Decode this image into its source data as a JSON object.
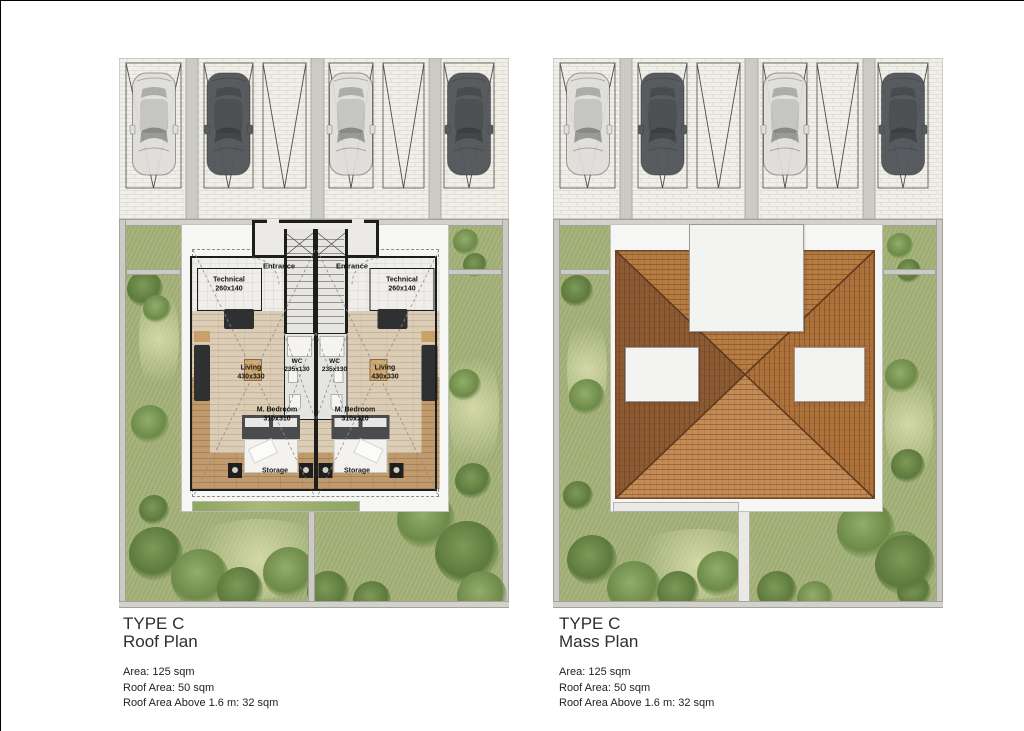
{
  "panels": {
    "roof": {
      "title_line1": "TYPE C",
      "title_line2": "Roof Plan",
      "stat_area": "Area: 125 sqm",
      "stat_roof": "Roof Area: 50 sqm",
      "stat_roof_above": "Roof Area Above 1.6 m: 32 sqm"
    },
    "mass": {
      "title_line1": "TYPE C",
      "title_line2": "Mass Plan",
      "stat_area": "Area: 125 sqm",
      "stat_roof": "Roof Area: 50 sqm",
      "stat_roof_above": "Roof Area Above 1.6 m: 32 sqm"
    }
  },
  "rooms": {
    "entrance": "Entrance",
    "technical": "Technical",
    "technical_dim": "260x140",
    "living": "Living",
    "living_dim": "430x330",
    "wc": "WC",
    "wc_dim": "235x130",
    "bedroom": "M. Bedroom",
    "bedroom_dim": "310x310",
    "storage": "Storage"
  },
  "colors": {
    "roof_face_left": "#8c5a33",
    "roof_face_right": "#ad713a",
    "roof_face_top": "#b67d43",
    "roof_face_bottom": "#c48c55",
    "grass": "#a3b077",
    "wood_floor": "#dbcdb5",
    "wood_dark": "#c09a6c",
    "wall_black": "#1d1d1b",
    "paving": "#f0efe9",
    "car_light": "#dfdedb",
    "car_dark": "#54575b"
  }
}
